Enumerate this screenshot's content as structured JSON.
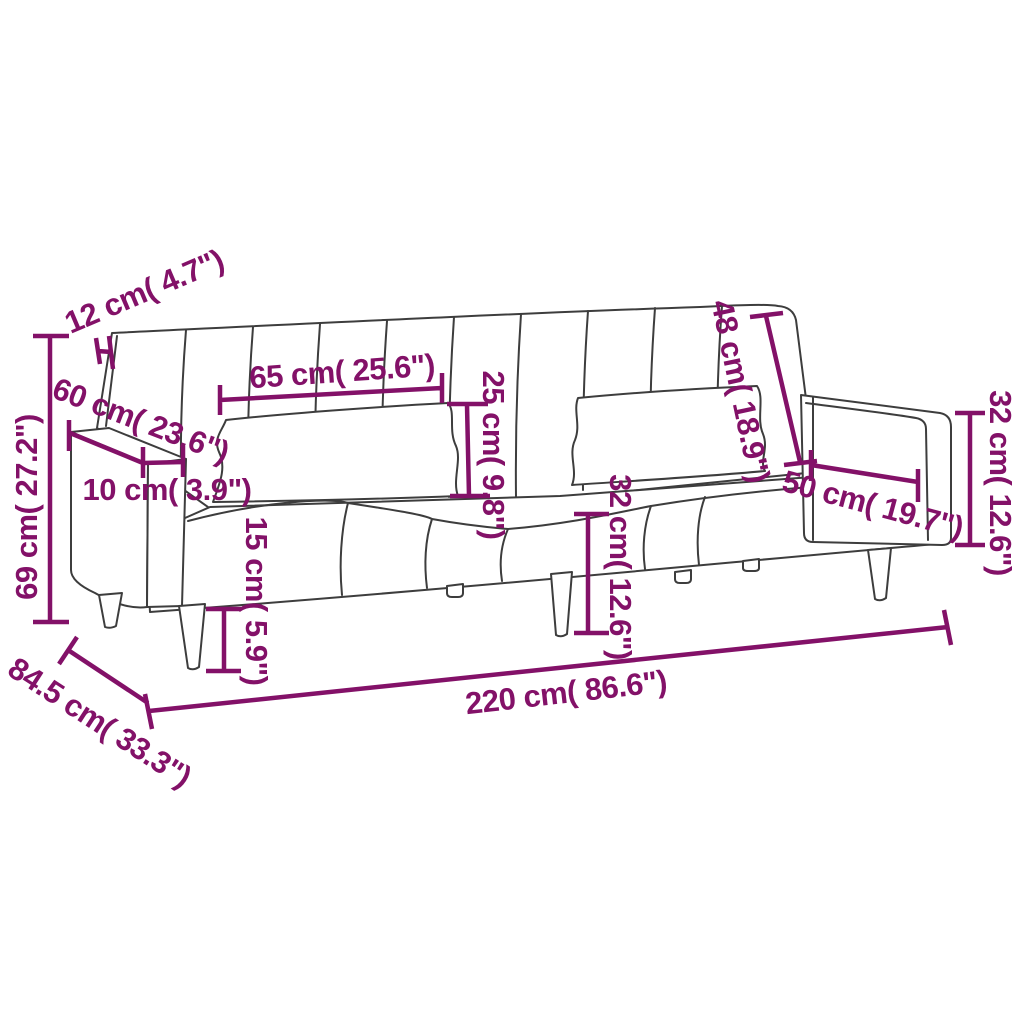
{
  "diagram": {
    "type": "furniture-dimension-diagram",
    "subject": "two-seater sofa bed with armrests and lumbar pillows",
    "background_color": "#ffffff",
    "outline_color": "#3d3d3d",
    "dimension_color": "#831168",
    "dimensions": [
      {
        "id": "overall-height",
        "cm": "69",
        "inches": "27.2",
        "label": "69 cm( 27.2\")"
      },
      {
        "id": "backrest-thickness",
        "cm": "12",
        "inches": "4.7",
        "label": "12 cm( 4.7\")"
      },
      {
        "id": "armrest-depth",
        "cm": "60",
        "inches": "23.6",
        "label": "60 cm( 23.6\")"
      },
      {
        "id": "armrest-width",
        "cm": "10",
        "inches": "3.9",
        "label": "10 cm( 3.9\")"
      },
      {
        "id": "backrest-section-width",
        "cm": "65",
        "inches": "25.6",
        "label": "65 cm( 25.6\")"
      },
      {
        "id": "pillow-height",
        "cm": "25",
        "inches": "9.8",
        "label": "25 cm( 9.8\")"
      },
      {
        "id": "leg-height",
        "cm": "15",
        "inches": "5.9",
        "label": "15 cm( 5.9\")"
      },
      {
        "id": "backrest-height",
        "cm": "48",
        "inches": "18.9",
        "label": "48 cm( 18.9\")"
      },
      {
        "id": "armrest-length",
        "cm": "50",
        "inches": "19.7",
        "label": "50 cm( 19.7\")"
      },
      {
        "id": "seat-height",
        "cm": "32",
        "inches": "12.6",
        "label": "32 cm( 12.6\")"
      },
      {
        "id": "armrest-height",
        "cm": "32",
        "inches": "12.6",
        "label": "32 cm( 12.6\")"
      },
      {
        "id": "overall-width",
        "cm": "220",
        "inches": "86.6",
        "label": "220 cm( 86.6\")"
      },
      {
        "id": "overall-depth",
        "cm": "84.5",
        "inches": "33.3",
        "label": "84.5 cm( 33.3\")"
      }
    ]
  }
}
